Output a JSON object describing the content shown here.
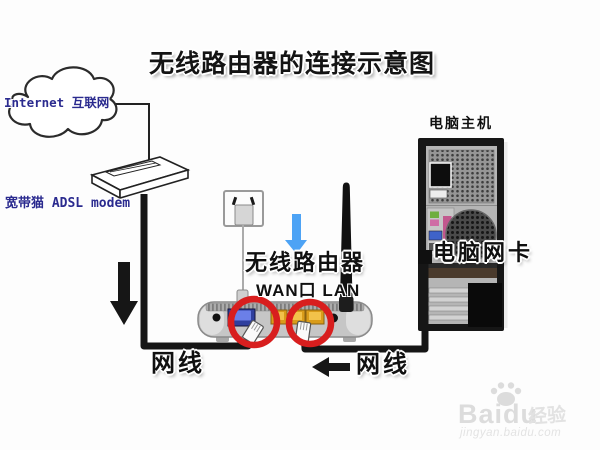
{
  "title": "无线路由器的连接示意图",
  "cloud": {
    "label": "Internet 互联网"
  },
  "modem": {
    "label": "宽带猫 ADSL modem"
  },
  "router": {
    "label": "无线路由器",
    "ports_label": "WAN口 LAN"
  },
  "pc": {
    "label": "电脑主机",
    "nic_label": "电脑网卡"
  },
  "cables": {
    "modem_to_router_label": "网线",
    "router_to_pc_label": "网线"
  },
  "watermark": {
    "brand": "Baidu",
    "brand_suffix": "经验",
    "url": "jingyan.baidu.com"
  },
  "colors": {
    "label_navy": "#2b2b8f",
    "highlight_red": "#d81e1e",
    "arrow_blue": "#4da3f5",
    "wan_port_blue": "#2f3f9e",
    "lan_port_yellow": "#d99c1a",
    "cable_black": "#161616",
    "watermark_gray": "#dcdcdc"
  }
}
